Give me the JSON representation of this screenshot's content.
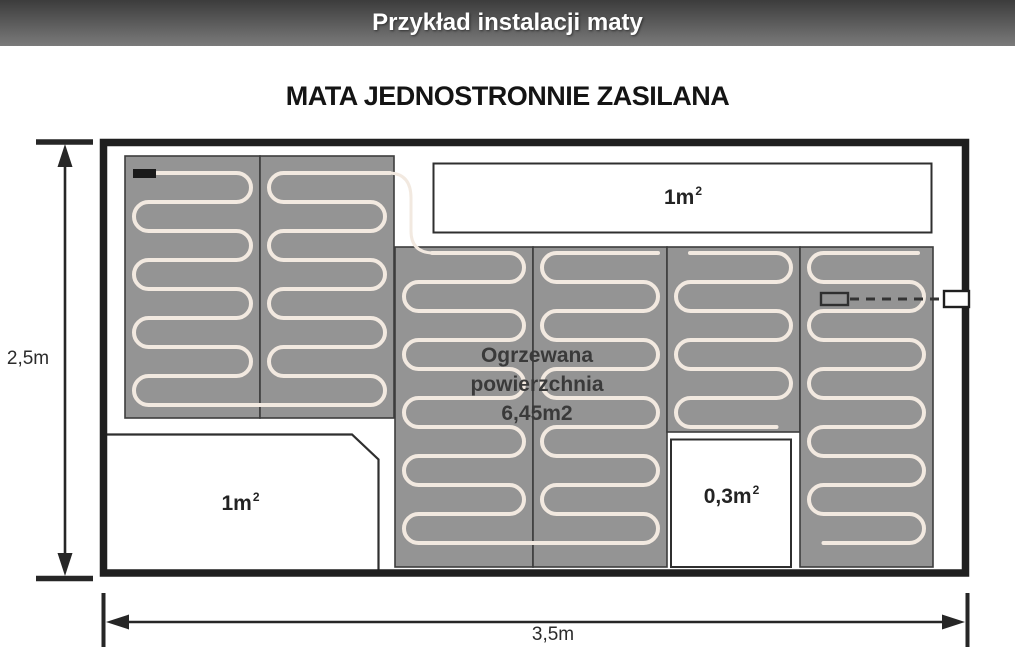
{
  "header": {
    "title": "Przykład instalacji maty"
  },
  "diagram": {
    "title": "MATA JEDNOSTRONNIE ZASILANA",
    "heated_area_label": {
      "lines": [
        "Ogrzewana",
        "powierzchnia",
        "6,45m2"
      ]
    },
    "unheated_areas": {
      "top_right": {
        "base": "1m",
        "sup": "2"
      },
      "bottom_left": {
        "base": "1m",
        "sup": "2"
      },
      "small_cutout": {
        "base": "0,3m",
        "sup": "2"
      }
    },
    "dimensions": {
      "room_height": "2,5m",
      "room_width": "3,5m"
    },
    "colors": {
      "mat": "#949494",
      "cable": "#f2e9e0",
      "wall": "#1f1f1f",
      "header_bar_top": "#3c3c3c",
      "header_bar_bottom": "#7a7a7a"
    }
  }
}
